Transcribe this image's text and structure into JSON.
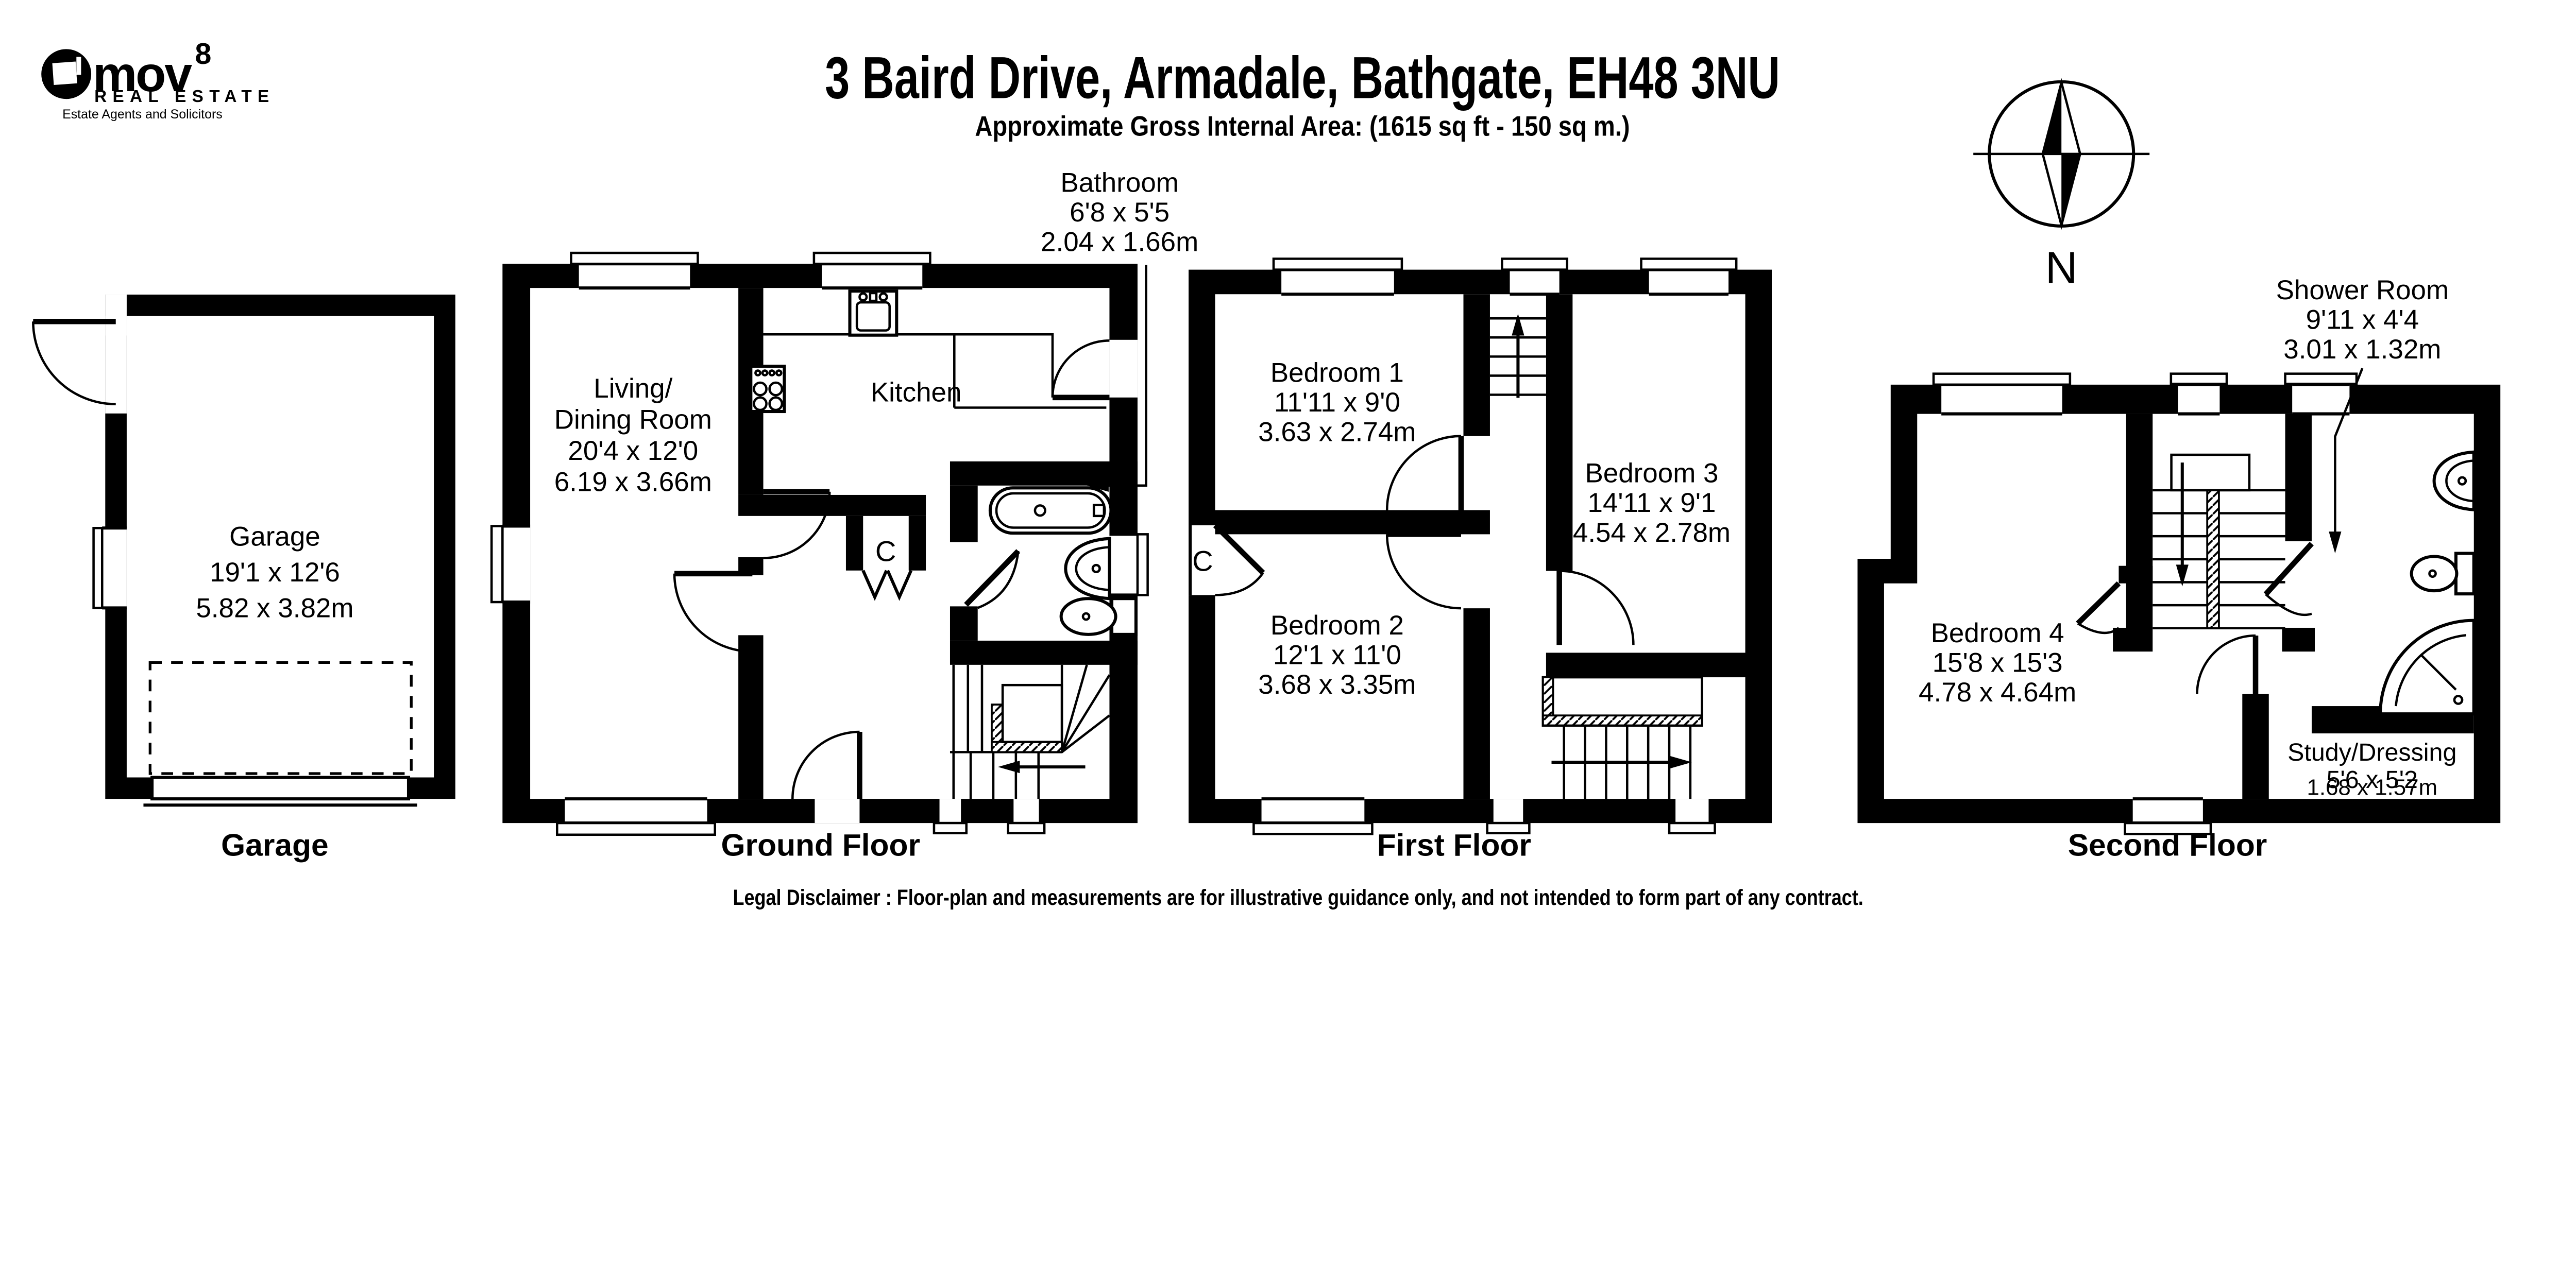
{
  "logo": {
    "brand": "mov",
    "superscript": "8",
    "line2": "REAL ESTATE",
    "line3": "Estate Agents and Solicitors"
  },
  "header": {
    "title": "3 Baird Drive, Armadale, Bathgate, EH48 3NU",
    "subtitle": "Approximate Gross Internal Area: (1615 sq ft - 150 sq m.)"
  },
  "compass": {
    "label": "N"
  },
  "floors": {
    "garage": {
      "title": "Garage",
      "room": {
        "name": "Garage",
        "imperial": "19'1 x 12'6",
        "metric": "5.82 x 3.82m"
      }
    },
    "ground": {
      "title": "Ground Floor",
      "living": {
        "name1": "Living/",
        "name2": "Dining Room",
        "imperial": "20'4 x 12'0",
        "metric": "6.19 x 3.66m"
      },
      "kitchen": {
        "name": "Kitchen"
      },
      "bathroom": {
        "name": "Bathroom",
        "imperial": "6'8 x 5'5",
        "metric": "2.04 x 1.66m"
      },
      "cupboard": "C"
    },
    "first": {
      "title": "First Floor",
      "bedroom1": {
        "name": "Bedroom 1",
        "imperial": "11'11 x 9'0",
        "metric": "3.63 x 2.74m"
      },
      "bedroom2": {
        "name": "Bedroom 2",
        "imperial": "12'1 x 11'0",
        "metric": "3.68 x 3.35m"
      },
      "bedroom3": {
        "name": "Bedroom 3",
        "imperial": "14'11 x 9'1",
        "metric": "4.54 x 2.78m"
      },
      "cupboard": "C"
    },
    "second": {
      "title": "Second Floor",
      "bedroom4": {
        "name": "Bedroom 4",
        "imperial": "15'8 x 15'3",
        "metric": "4.78 x 4.64m"
      },
      "shower": {
        "name": "Shower Room",
        "imperial": "9'11 x 4'4",
        "metric": "3.01 x 1.32m"
      },
      "study": {
        "name": "Study/Dressing",
        "imperial": "5'6 x 5'2",
        "metric": "1.68 x 1.57m"
      },
      "cupboard": "C"
    }
  },
  "footer": {
    "disclaimer": "Legal Disclaimer : Floor-plan and measurements are for illustrative guidance only, and not intended to form part of any contract."
  }
}
